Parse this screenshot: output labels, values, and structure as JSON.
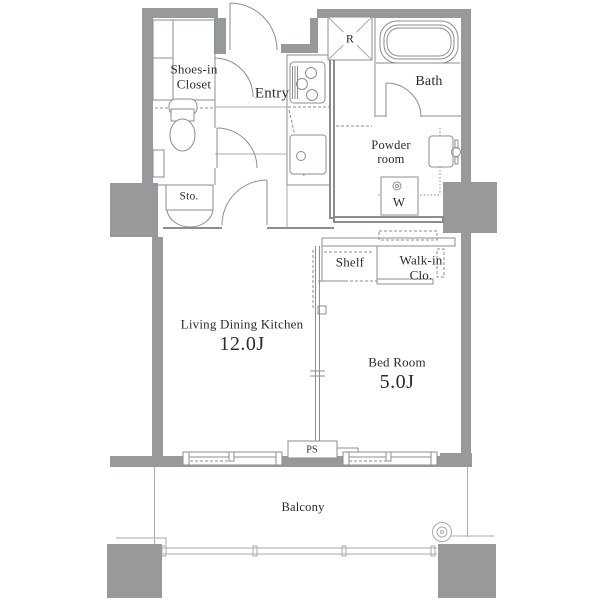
{
  "plan": {
    "rooms": {
      "ldk": {
        "name": "Living Dining Kitchen",
        "area": "12.0J"
      },
      "bedroom": {
        "name": "Bed Room",
        "area": "5.0J"
      },
      "entry": {
        "label": "Entry"
      },
      "bath": {
        "label": "Bath"
      },
      "powder_room": {
        "label": "Powder room"
      },
      "shoes_closet": {
        "label": "Shoes-in Closet"
      },
      "storage": {
        "label": "Sto."
      },
      "shelf": {
        "label": "Shelf"
      },
      "walk_in_closet": {
        "label": "Walk-in Clo."
      },
      "balcony": {
        "label": "Balcony"
      }
    },
    "symbols": {
      "refrigerator": "R",
      "washer": "W",
      "pipe_space": "PS"
    },
    "colors": {
      "wall": "#97999b",
      "line": "#8b8e91",
      "light_line": "#a9abad",
      "text": "#2b2b2b",
      "background": "#ffffff"
    }
  }
}
